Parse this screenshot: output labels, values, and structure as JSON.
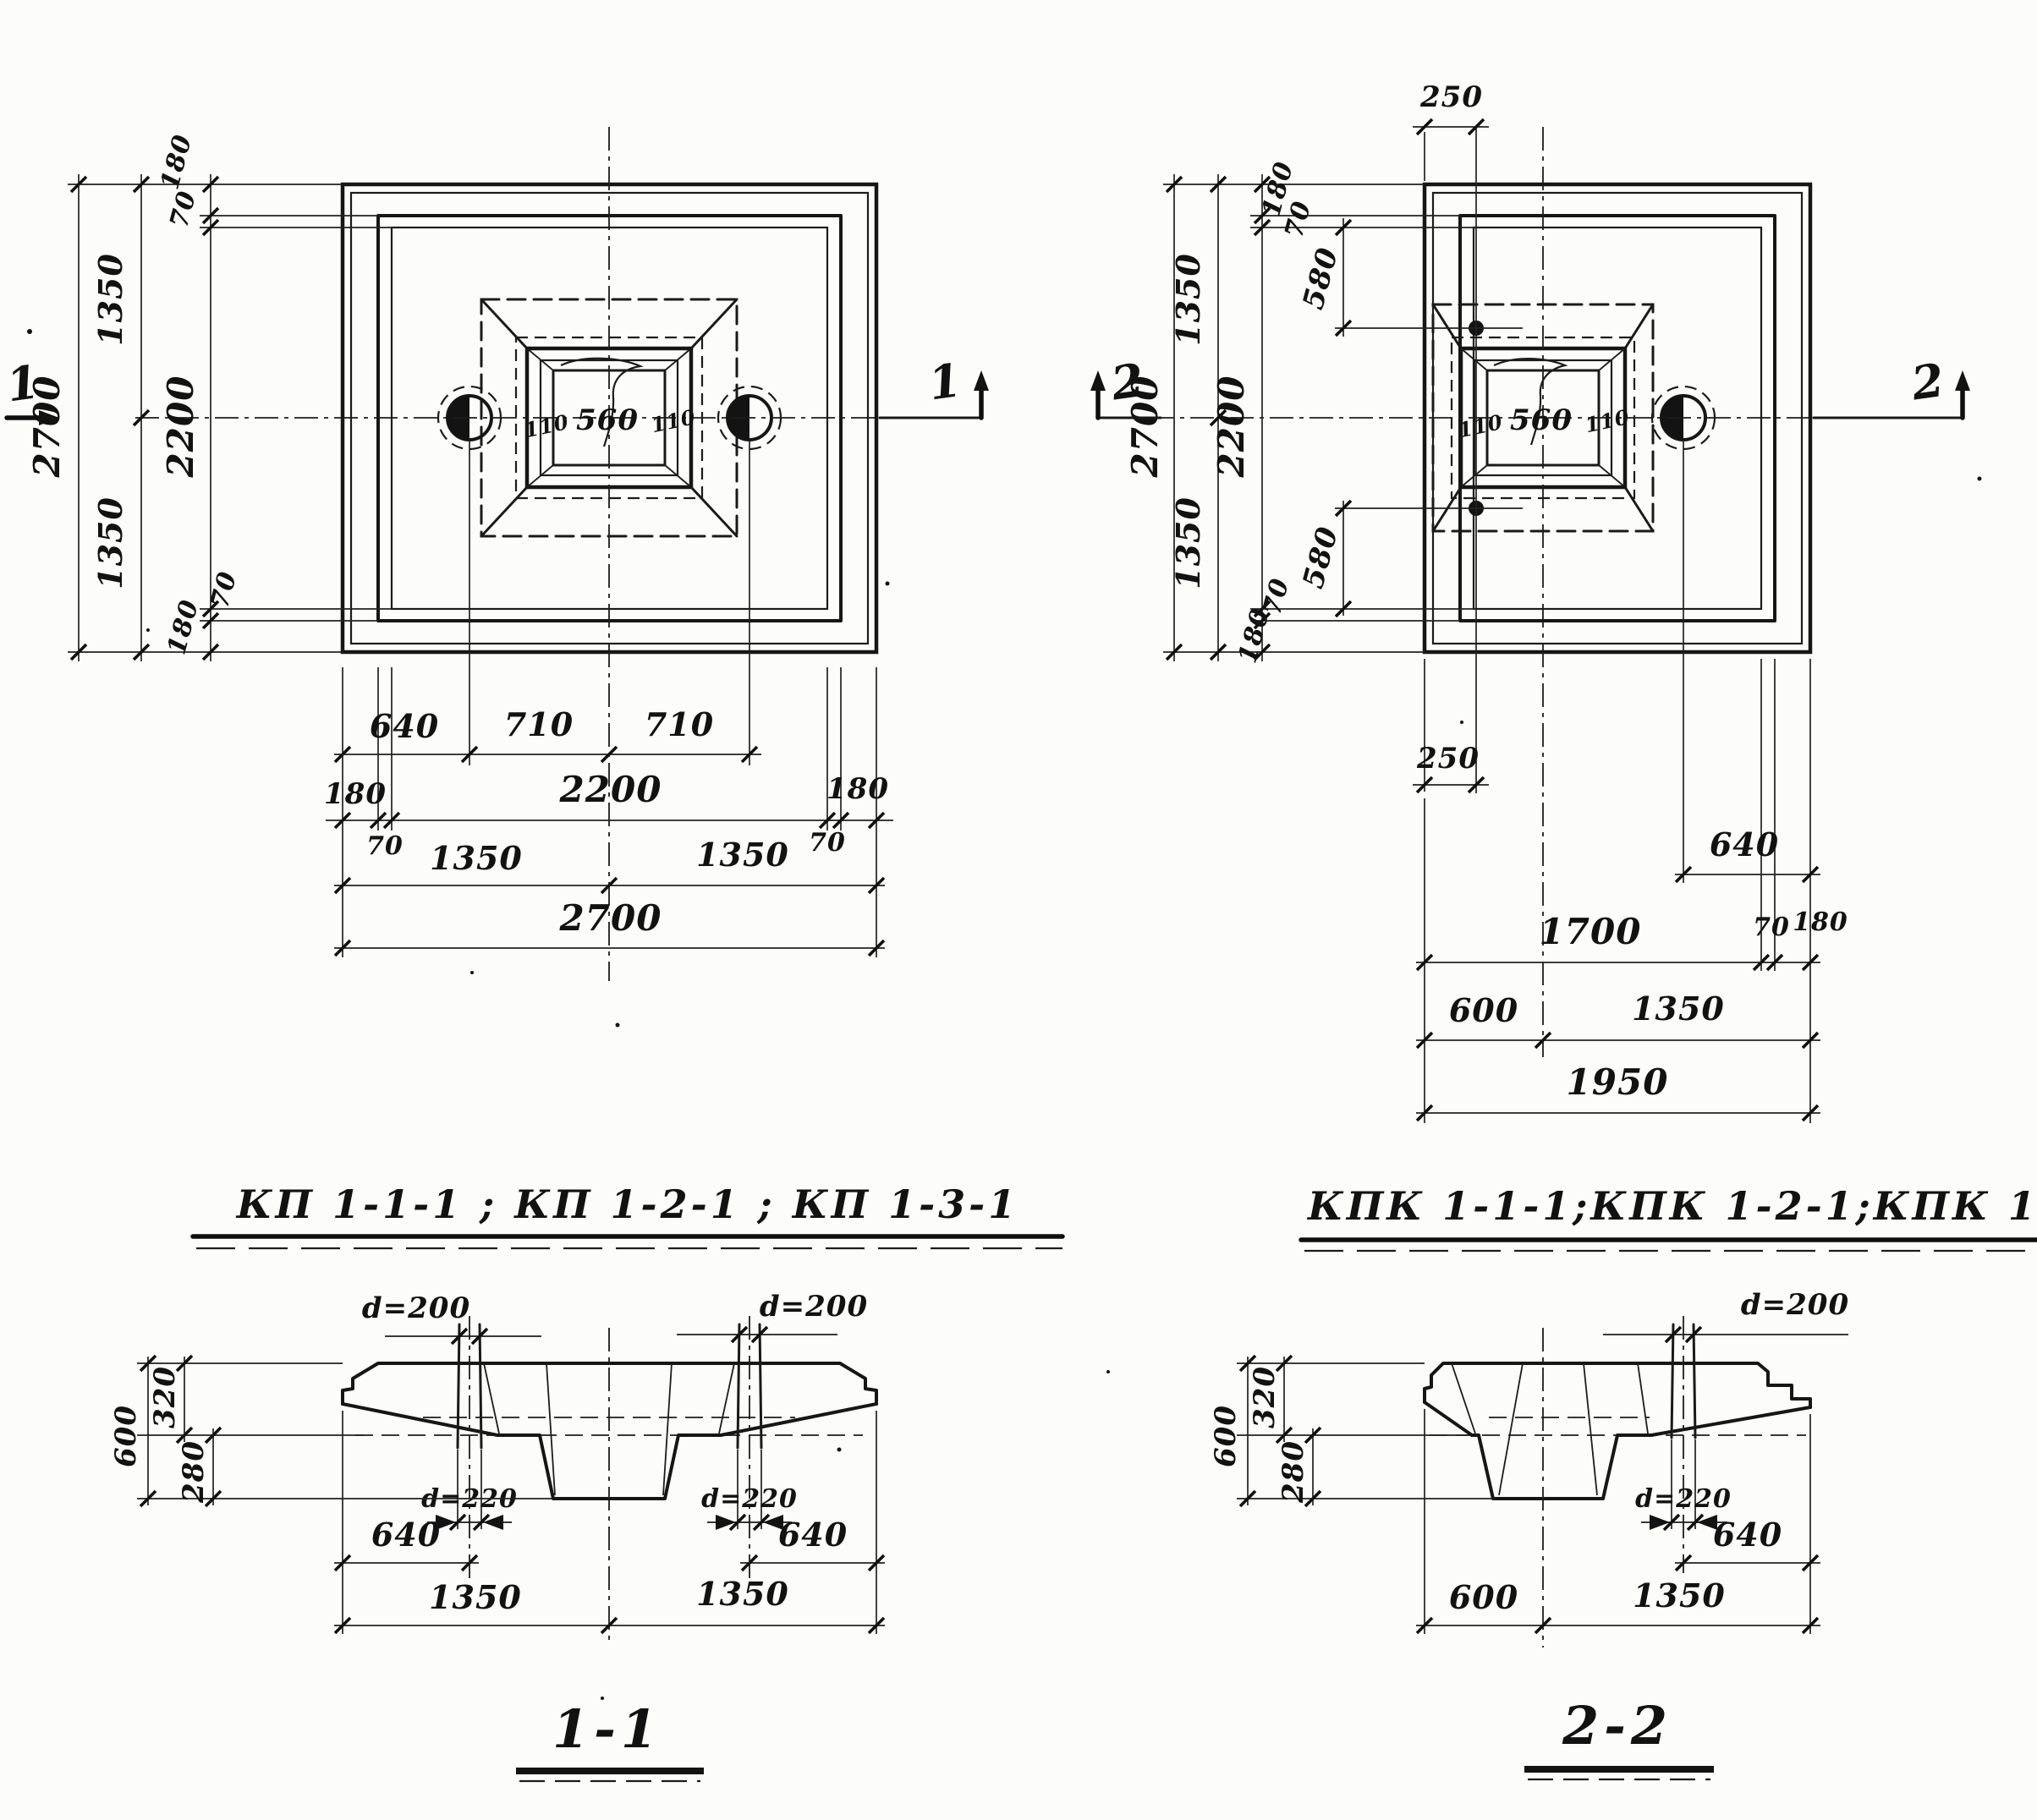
{
  "titles": {
    "left": "КП 1-1-1 ; КП 1-2-1 ; КП 1-3-1",
    "right": "КПК 1-1-1;КПК 1-2-1;КПК 1-3-1"
  },
  "left_plan": {
    "mark": "1",
    "side_chain": [
      "2700",
      "1350",
      "1350",
      "180",
      "70",
      "2200",
      "70",
      "180"
    ],
    "socket_dims": [
      "110",
      "560",
      "110"
    ],
    "bottom_chain": [
      "640",
      "710",
      "710",
      "180",
      "2200",
      "180",
      "70",
      "70",
      "1350",
      "1350",
      "2700"
    ]
  },
  "right_plan": {
    "mark": "2",
    "side_chain": [
      "2700",
      "1350",
      "1350",
      "180",
      "70",
      "2200",
      "70",
      "180"
    ],
    "offset_dims": [
      "250",
      "580",
      "580",
      "250"
    ],
    "socket_dims": [
      "110",
      "560",
      "110"
    ],
    "bottom_chain": [
      "640",
      "1700",
      "70",
      "180",
      "600",
      "1350",
      "1950"
    ]
  },
  "section_1_1": {
    "title": "1-1",
    "hole_top": [
      "d=200",
      "d=200"
    ],
    "hole_bottom": [
      "d=220",
      "d=220"
    ],
    "height_chain": [
      "600",
      "320",
      "280"
    ],
    "bottom_chain": [
      "640",
      "640",
      "1350",
      "1350"
    ]
  },
  "section_2_2": {
    "title": "2-2",
    "hole_top": "d=200",
    "hole_bottom": "d=220",
    "height_chain": [
      "600",
      "320",
      "280"
    ],
    "bottom_chain": [
      "640",
      "600",
      "1350"
    ]
  }
}
